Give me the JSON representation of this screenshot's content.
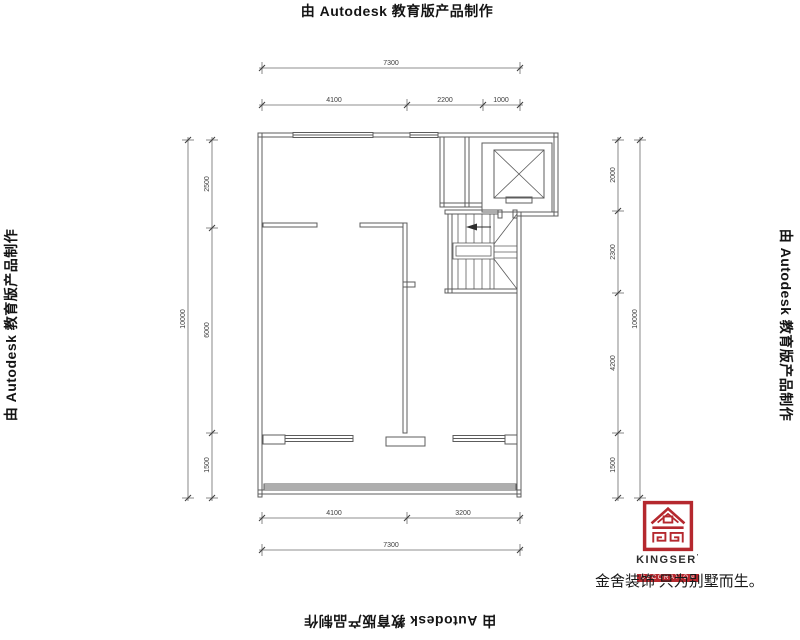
{
  "watermark": {
    "text": "由 Autodesk 教育版产品制作"
  },
  "dimensions": {
    "top": {
      "overall": "7300",
      "segments": [
        "4100",
        "2200",
        "1000"
      ]
    },
    "bottom": {
      "segments": [
        "4100",
        "3200"
      ],
      "overall": "7300"
    },
    "left": {
      "overall": "10000",
      "segments": [
        "2500",
        "6000",
        "1500"
      ]
    },
    "right": {
      "segments": [
        "2000",
        "2300",
        "4200",
        "1500"
      ],
      "overall": "10000"
    }
  },
  "logo": {
    "brand": "KINGSER",
    "brand_mark": "’",
    "subtitle": "DECORATION",
    "tagline": "金舍装饰 只为别墅而生。"
  },
  "colors": {
    "logo_red": "#b5282e",
    "line_gray": "#5c5c5c",
    "dim_gray": "#6a6a6a",
    "text_black": "#141414"
  }
}
